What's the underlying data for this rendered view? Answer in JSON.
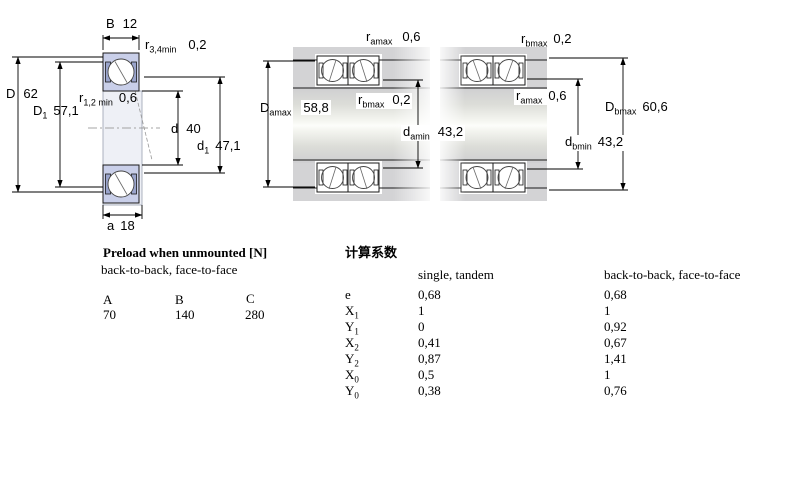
{
  "diagram_left": {
    "b_label": "B",
    "b_value": "12",
    "r34_base": "r",
    "r34_sub": "3,4min",
    "r34_value": "0,2",
    "r12_base": "r",
    "r12_sub": "1,2 min",
    "r12_value": "0,6",
    "D_label": "D",
    "D_value": "62",
    "D1_base": "D",
    "D1_sub": "1",
    "D1_value": "57,1",
    "d_label": "d",
    "d_value": "40",
    "d1_base": "d",
    "d1_sub": "1",
    "d1_value": "47,1",
    "a_label": "a",
    "a_value": "18"
  },
  "diagram_middle": {
    "top_base": "r",
    "top_sub": "amax",
    "top_value": "0,6",
    "mid_base": "r",
    "mid_sub": "bmax",
    "mid_value": "0,2",
    "Da_base": "D",
    "Da_sub": "amax",
    "Da_value": "58,8",
    "da_base": "d",
    "da_sub": "amin",
    "da_value": "43,2"
  },
  "diagram_right": {
    "top_base": "r",
    "top_sub": "bmax",
    "top_value": "0,2",
    "mid_base": "r",
    "mid_sub": "amax",
    "mid_value": "0,6",
    "db_base": "d",
    "db_sub": "bmin",
    "db_value": "43,2",
    "Db_base": "D",
    "Db_sub": "bmax",
    "Db_value": "60,6"
  },
  "preload": {
    "title": "Preload when unmounted [N]",
    "subtitle": "back-to-back, face-to-face",
    "columns": [
      "A",
      "B",
      "C"
    ],
    "values": [
      "70",
      "140",
      "280"
    ]
  },
  "factors": {
    "title": "计算系数",
    "col1_header": "single, tandem",
    "col2_header": "back-to-back, face-to-face",
    "rows": [
      {
        "base": "e",
        "sub": "",
        "v1": "0,68",
        "v2": "0,68"
      },
      {
        "base": "X",
        "sub": "1",
        "v1": "1",
        "v2": "1"
      },
      {
        "base": "Y",
        "sub": "1",
        "v1": "0",
        "v2": "0,92"
      },
      {
        "base": "X",
        "sub": "2",
        "v1": "0,41",
        "v2": "0,67"
      },
      {
        "base": "Y",
        "sub": "2",
        "v1": "0,87",
        "v2": "1,41"
      },
      {
        "base": "X",
        "sub": "0",
        "v1": "0,5",
        "v2": "1"
      },
      {
        "base": "Y",
        "sub": "0",
        "v1": "0,38",
        "v2": "0,76"
      }
    ]
  },
  "colors": {
    "bearing_fill": "#c9cfe9",
    "housing_gray": "#d3d3d5",
    "line": "#000000",
    "background": "#ffffff"
  }
}
